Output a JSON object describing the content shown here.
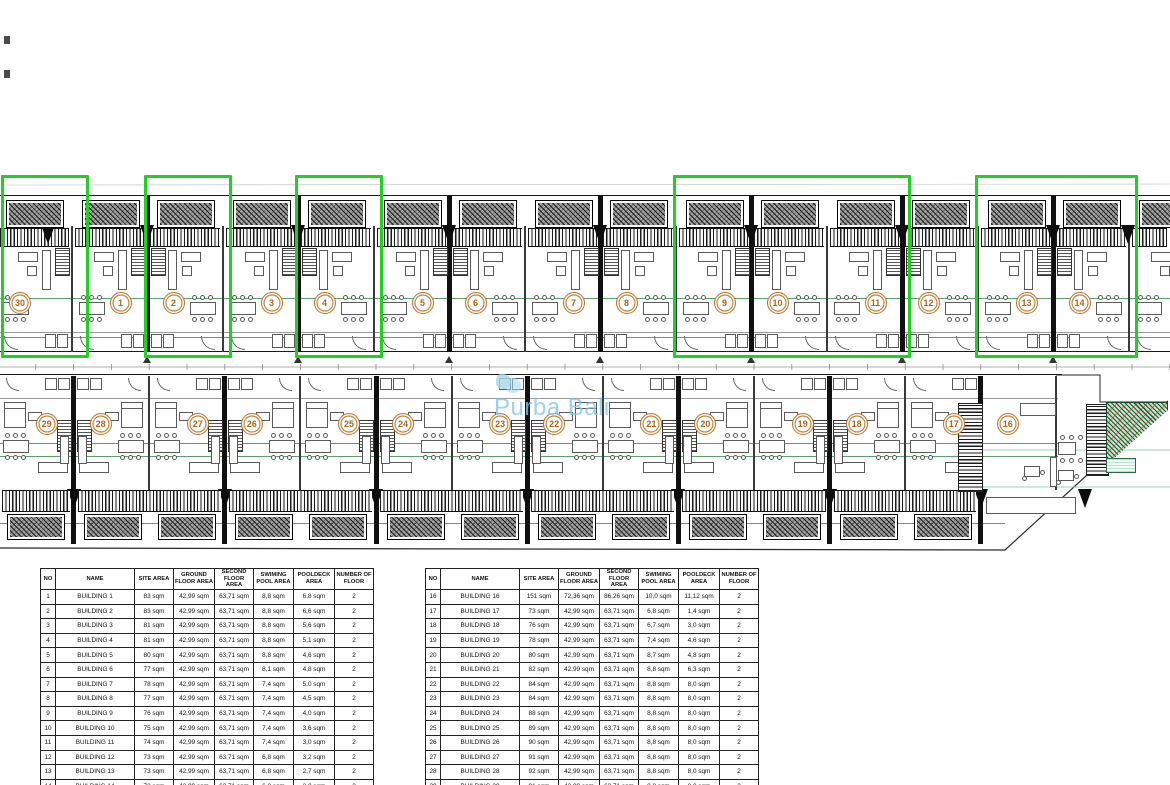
{
  "plan": {
    "watermark": {
      "text": "Purba Bali",
      "color": "#87c5e4"
    },
    "colors": {
      "highlight_green": "#21d121",
      "badge_orange": "#b5742e",
      "accent_green": "#3f8e52",
      "landscape_red": "#be2828"
    },
    "top_row_units": [
      "30",
      "1",
      "2",
      "3",
      "4",
      "5",
      "6",
      "7",
      "8",
      "9",
      "10",
      "11",
      "12",
      "13",
      "14",
      "15"
    ],
    "top_row_circles": [
      "30",
      "1",
      "2",
      "3",
      "4",
      "5",
      "6",
      "7",
      "8",
      "9",
      "10",
      "11",
      "12",
      "13",
      "14"
    ],
    "bottom_row_units": [
      "29",
      "28",
      "27",
      "26",
      "25",
      "24",
      "23",
      "22",
      "21",
      "20",
      "19",
      "18",
      "17",
      "16"
    ],
    "highlight_groups": [
      [
        "30"
      ],
      [
        "2"
      ],
      [
        "4"
      ],
      [
        "9",
        "10",
        "11"
      ],
      [
        "13",
        "14"
      ]
    ]
  },
  "tables": {
    "headers": [
      "NO",
      "NAME",
      "SITE AREA",
      "GROUND FLOOR AREA",
      "SECOND FLOOR AREA",
      "SWIMING POOL AREA",
      "POOLDECK AREA",
      "NUMBER OF FLOOR"
    ],
    "left": {
      "rows": [
        [
          "1",
          "BUILDING 1",
          "83 sqm",
          "42,99 sqm",
          "63,71 sqm",
          "8,8 sqm",
          "6,8 sqm",
          "2"
        ],
        [
          "2",
          "BUILDING 2",
          "83 sqm",
          "42,99 sqm",
          "63,71 sqm",
          "8,8 sqm",
          "6,6 sqm",
          "2"
        ],
        [
          "3",
          "BUILDING 3",
          "81 sqm",
          "42,99 sqm",
          "63,71 sqm",
          "8,8 sqm",
          "5,6 sqm",
          "2"
        ],
        [
          "4",
          "BUILDING 4",
          "81 sqm",
          "42,99 sqm",
          "63,71 sqm",
          "8,8 sqm",
          "5,1 sqm",
          "2"
        ],
        [
          "5",
          "BUILDING 5",
          "80 sqm",
          "42,99 sqm",
          "63,71 sqm",
          "8,8 sqm",
          "4,6 sqm",
          "2"
        ],
        [
          "6",
          "BUILDING 6",
          "77 sqm",
          "42,99 sqm",
          "63,71 sqm",
          "8,1 sqm",
          "4,8 sqm",
          "2"
        ],
        [
          "7",
          "BUILDING 7",
          "78 sqm",
          "42,99 sqm",
          "63,71 sqm",
          "7,4 sqm",
          "5,0 sqm",
          "2"
        ],
        [
          "8",
          "BUILDING 8",
          "77 sqm",
          "42,99 sqm",
          "63,71 sqm",
          "7,4 sqm",
          "4,5 sqm",
          "2"
        ],
        [
          "9",
          "BUILDING 9",
          "76 sqm",
          "42,99 sqm",
          "63,71 sqm",
          "7,4 sqm",
          "4,0 sqm",
          "2"
        ],
        [
          "10",
          "BUILDING 10",
          "75 sqm",
          "42,99 sqm",
          "63,71 sqm",
          "7,4 sqm",
          "3,6 sqm",
          "2"
        ],
        [
          "11",
          "BUILDING 11",
          "74 sqm",
          "42,99 sqm",
          "63,71 sqm",
          "7,4 sqm",
          "3,0 sqm",
          "2"
        ],
        [
          "12",
          "BUILDING 12",
          "73 sqm",
          "42,99 sqm",
          "63,71 sqm",
          "6,8 sqm",
          "3,2 sqm",
          "2"
        ],
        [
          "13",
          "BUILDING 13",
          "73 sqm",
          "42,99 sqm",
          "63,71 sqm",
          "6,8 sqm",
          "2,7 sqm",
          "2"
        ],
        [
          "14",
          "BUILDING 14",
          "72 sqm",
          "42,99 sqm",
          "63,71 sqm",
          "6,8 sqm",
          "2,0 sqm",
          "2"
        ],
        [
          "15",
          "BUILDING 15",
          "114 sqm",
          "42,99 sqm",
          "63,71 sqm",
          "16,3 sqm",
          "17,1 sqm",
          "2"
        ]
      ]
    },
    "right": {
      "rows": [
        [
          "16",
          "BUILDING 16",
          "151 sqm",
          "72,36 sqm",
          "86,26 sqm",
          "10,0 sqm",
          "11,12 sqm",
          "2"
        ],
        [
          "17",
          "BUILDING 17",
          "73 sqm",
          "42,99 sqm",
          "63,71 sqm",
          "6,8 sqm",
          "1,4 sqm",
          "2"
        ],
        [
          "18",
          "BUILDING 18",
          "76 sqm",
          "42,99 sqm",
          "63,71 sqm",
          "6,7 sqm",
          "3,0 sqm",
          "2"
        ],
        [
          "19",
          "BUILDING 19",
          "78 sqm",
          "42,99 sqm",
          "63,71 sqm",
          "7,4 sqm",
          "4,6 sqm",
          "2"
        ],
        [
          "20",
          "BUILDING 20",
          "80 sqm",
          "42,99 sqm",
          "63,71 sqm",
          "8,7 sqm",
          "4,8 sqm",
          "2"
        ],
        [
          "21",
          "BUILDING 21",
          "82 sqm",
          "42,99 sqm",
          "63,71 sqm",
          "8,8 sqm",
          "6,3 sqm",
          "2"
        ],
        [
          "22",
          "BUILDING 22",
          "84 sqm",
          "42,99 sqm",
          "63,71 sqm",
          "8,8 sqm",
          "8,0 sqm",
          "2"
        ],
        [
          "23",
          "BUILDING 23",
          "84 sqm",
          "42,99 sqm",
          "63,71 sqm",
          "8,8 sqm",
          "8,0 sqm",
          "2"
        ],
        [
          "24",
          "BUILDING 24",
          "88 sqm",
          "42,99 sqm",
          "63,71 sqm",
          "8,8 sqm",
          "8,0 sqm",
          "2"
        ],
        [
          "25",
          "BUILDING 25",
          "89 sqm",
          "42,99 sqm",
          "63,71 sqm",
          "8,8 sqm",
          "8,0 sqm",
          "2"
        ],
        [
          "26",
          "BUILDING 26",
          "90 sqm",
          "42,99 sqm",
          "63,71 sqm",
          "8,8 sqm",
          "8,0 sqm",
          "2"
        ],
        [
          "27",
          "BUILDING 27",
          "91 sqm",
          "42,99 sqm",
          "63,71 sqm",
          "8,8 sqm",
          "8,0 sqm",
          "2"
        ],
        [
          "28",
          "BUILDING 28",
          "92 sqm",
          "42,99 sqm",
          "63,71 sqm",
          "8,8 sqm",
          "8,0 sqm",
          "2"
        ],
        [
          "29",
          "BUILDING 29",
          "91 sqm",
          "42,99 sqm",
          "63,71 sqm",
          "8,8 sqm",
          "8,0 sqm",
          "2"
        ],
        [
          "30",
          "BUILDING 30",
          "95 sqm",
          "42,99 sqm",
          "63,71 sqm",
          "8,8 sqm",
          "6,5 sqm",
          "2"
        ]
      ]
    }
  }
}
